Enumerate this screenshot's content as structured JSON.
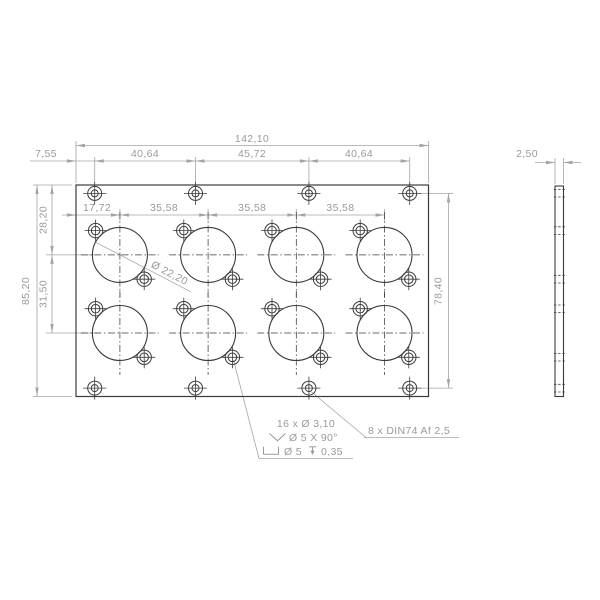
{
  "front_view": {
    "overall_width": "142,10",
    "edge_margin": "7,55",
    "mount_spacing": [
      "40,64",
      "45,72",
      "40,64"
    ],
    "first_column_offset": "17,72",
    "column_spacing": [
      "35,58",
      "35,58",
      "35,58"
    ],
    "overall_height": "85,20",
    "first_row_offset": "28,20",
    "row_spacing": "31,50",
    "mount_vertical_spacing": "78,40",
    "connector_diameter": "Ø 22,20"
  },
  "side_view": {
    "thickness": "2,50"
  },
  "notes": {
    "small_holes_count": "16 x Ø 3,10",
    "countersink": "Ø 5 X 90°",
    "counterbore_diameter": "Ø 5",
    "counterbore_depth": "0,35",
    "din_mount": "8 x DIN74 Af 2,5"
  },
  "colors": {
    "geometry": "#3b3b3b",
    "dimensions": "#a4a4a4",
    "dimension_text": "#9a9a9a",
    "background": "#ffffff"
  }
}
